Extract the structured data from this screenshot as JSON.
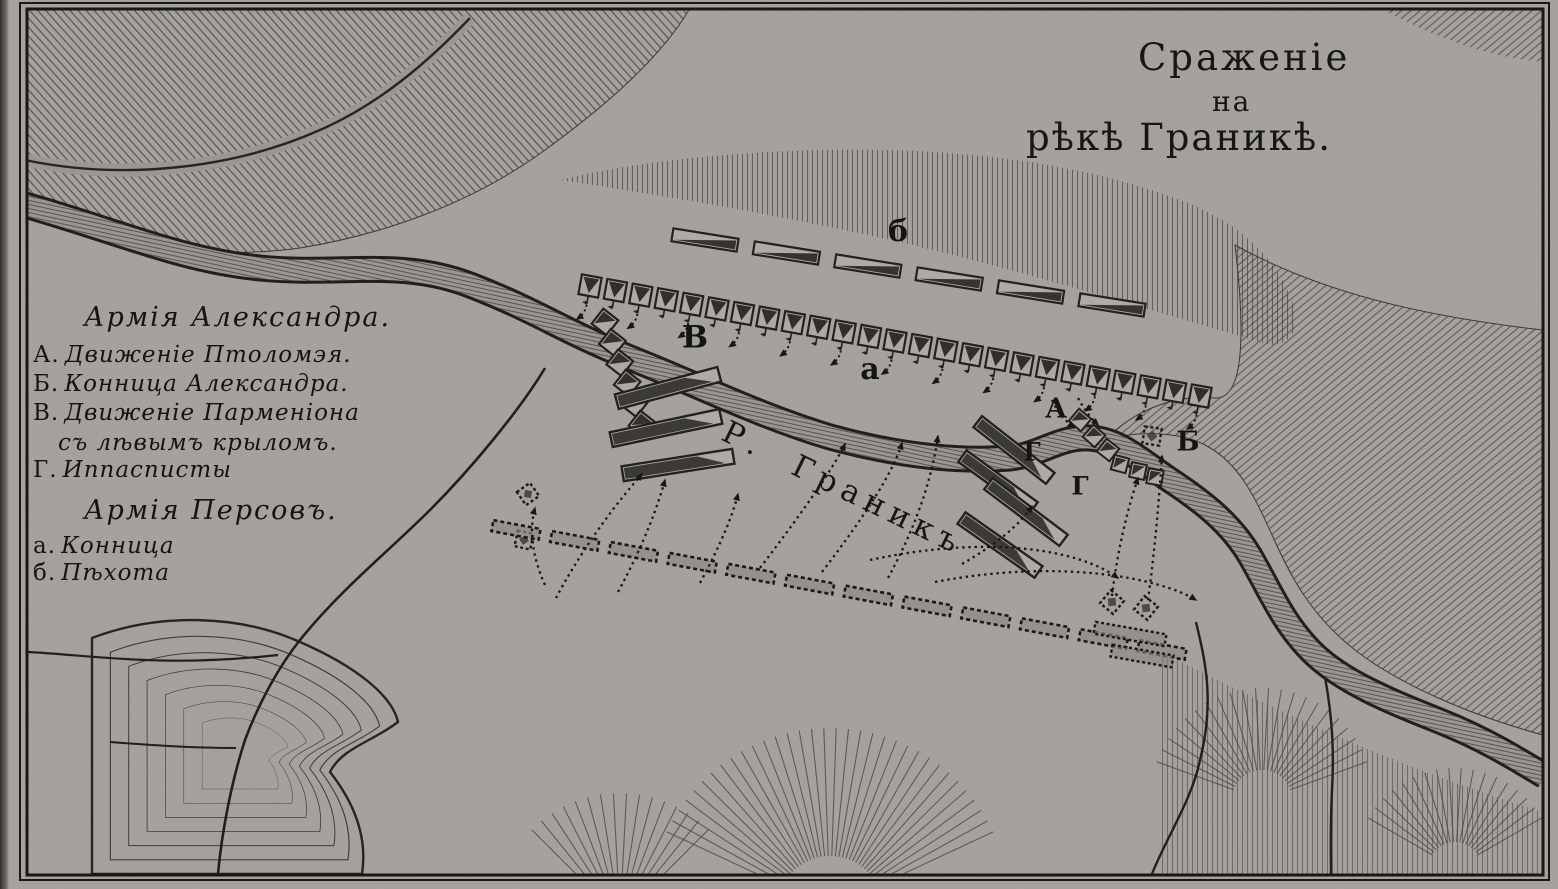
{
  "meta": {
    "paper": "#a8a5a0",
    "ink": "#1b1b1b",
    "hatch": "#4a4845"
  },
  "title": {
    "line1": "Сраженіе",
    "line2": "на",
    "line3": "рѣкѣ Граникѣ."
  },
  "legend": {
    "alexander_header": "Армія Александра.",
    "alexander_items": [
      {
        "key": "А.",
        "text": "Движеніе Птоломэя."
      },
      {
        "key": "Б.",
        "text": "Конница Александра."
      },
      {
        "key": "В.",
        "text": "Движеніе Парменіона"
      },
      {
        "key": "",
        "text": "съ лѣвымъ крыломъ."
      },
      {
        "key": "Г.",
        "text": "Иппасписты"
      }
    ],
    "persian_header": "Армія Персовъ.",
    "persian_items": [
      {
        "key": "а.",
        "text": "Конница"
      },
      {
        "key": "б.",
        "text": "Пѣхота"
      }
    ]
  },
  "map": {
    "river_label": "Р.  Граникъ",
    "labels": [
      {
        "text": "б",
        "x": 898,
        "y": 232,
        "size": 30
      },
      {
        "text": "В",
        "x": 695,
        "y": 338,
        "size": 31
      },
      {
        "text": "а",
        "x": 870,
        "y": 370,
        "size": 30
      },
      {
        "text": "А",
        "x": 1056,
        "y": 409,
        "size": 27
      },
      {
        "text": "Б",
        "x": 1188,
        "y": 442,
        "size": 27
      },
      {
        "text": "Г",
        "x": 1032,
        "y": 452,
        "size": 25
      },
      {
        "text": "Г",
        "x": 1080,
        "y": 486,
        "size": 25
      }
    ],
    "formations": {
      "persian_infantry": {
        "x1": 705,
        "y1": 240,
        "x2": 1112,
        "y2": 305,
        "count": 6,
        "len": 66,
        "h": 13
      },
      "persian_cavalry": {
        "x1": 590,
        "y1": 286,
        "x2": 1200,
        "y2": 396,
        "count": 25,
        "size": 20
      },
      "parmenion_column": {
        "x1": 605,
        "y1": 322,
        "x2": 642,
        "y2": 424,
        "count": 6,
        "size": 19
      },
      "macedonian_line": {
        "x1": 516,
        "y1": 530,
        "x2": 1162,
        "y2": 650,
        "count": 12,
        "len": 48,
        "h": 11
      },
      "left_bars": [
        {
          "cx": 668,
          "cy": 388,
          "len": 106,
          "h": 15,
          "rot": -15
        },
        {
          "cx": 666,
          "cy": 428,
          "len": 112,
          "h": 15,
          "rot": -12
        },
        {
          "cx": 678,
          "cy": 465,
          "len": 112,
          "h": 15,
          "rot": -9
        }
      ],
      "right_bars": [
        {
          "cx": 1014,
          "cy": 450,
          "len": 92,
          "h": 14,
          "rot": 38
        },
        {
          "cx": 998,
          "cy": 482,
          "len": 88,
          "h": 14,
          "rot": 36
        },
        {
          "cx": 1026,
          "cy": 512,
          "len": 94,
          "h": 14,
          "rot": 37
        },
        {
          "cx": 1000,
          "cy": 545,
          "len": 94,
          "h": 14,
          "rot": 35
        }
      ],
      "crossing_squares": [
        {
          "cx": 1080,
          "cy": 420,
          "size": 16,
          "rot": 40
        },
        {
          "cx": 1094,
          "cy": 436,
          "size": 16,
          "rot": 42
        },
        {
          "cx": 1108,
          "cy": 450,
          "size": 16,
          "rot": 38
        },
        {
          "cx": 1120,
          "cy": 464,
          "size": 15,
          "rot": 15
        },
        {
          "cx": 1138,
          "cy": 471,
          "size": 15,
          "rot": 12
        },
        {
          "cx": 1155,
          "cy": 477,
          "size": 15,
          "rot": 10
        }
      ],
      "dashed_squares": [
        {
          "cx": 1152,
          "cy": 436,
          "size": 17,
          "rot": 8
        },
        {
          "cx": 1112,
          "cy": 602,
          "size": 17,
          "rot": 40
        },
        {
          "cx": 1146,
          "cy": 608,
          "size": 17,
          "rot": 38
        },
        {
          "cx": 528,
          "cy": 494,
          "size": 16,
          "rot": -35
        },
        {
          "cx": 524,
          "cy": 540,
          "size": 16,
          "rot": 12
        }
      ],
      "dashed_bars": [
        {
          "cx": 1130,
          "cy": 634,
          "len": 72,
          "h": 12,
          "rot": 10
        },
        {
          "cx": 1142,
          "cy": 656,
          "len": 62,
          "h": 12,
          "rot": 10
        }
      ]
    },
    "arrows": [
      {
        "d": "M 556,598 C 576,560 606,515 642,474"
      },
      {
        "d": "M 618,592 C 645,542 658,505 665,480"
      },
      {
        "d": "M 545,585 C 532,556 529,530 535,508"
      },
      {
        "d": "M 700,583 C 722,542 733,514 738,494"
      },
      {
        "d": "M 760,568 C 808,505 835,465 845,444"
      },
      {
        "d": "M 822,572 C 868,512 894,470 902,443"
      },
      {
        "d": "M 888,578 C 922,515 933,470 938,436"
      },
      {
        "d": "M 870,560 C 990,534 1080,550 1118,578"
      },
      {
        "d": "M 935,582 C 1060,558 1160,578 1196,600"
      },
      {
        "d": "M 962,564 C 1000,542 1020,524 1032,506"
      },
      {
        "d": "M 1112,596 C 1116,562 1124,520 1138,478"
      },
      {
        "d": "M 1148,600 C 1153,564 1158,516 1162,456"
      },
      {
        "d": "M 1052,400 C 1057,412 1065,420 1074,428"
      },
      {
        "d": "M 1078,398 C 1084,409 1090,417 1098,425"
      }
    ]
  }
}
